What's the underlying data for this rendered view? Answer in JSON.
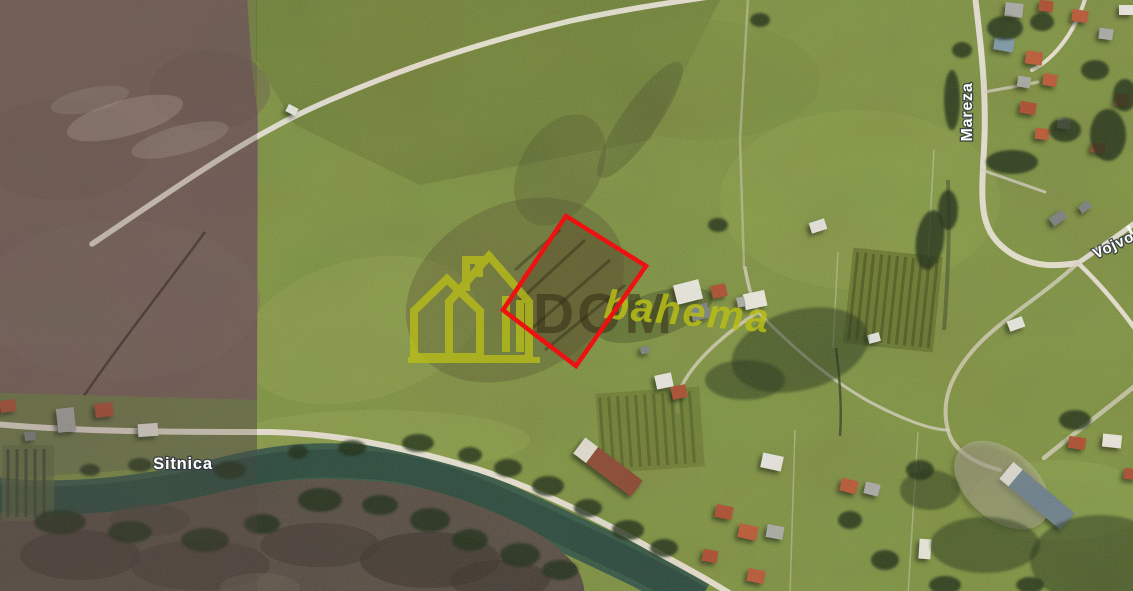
{
  "map": {
    "labels": {
      "river": "Sitnica",
      "road_mareza": "Mareza",
      "road_vojvode": "Vojvode"
    },
    "watermark": {
      "brand_prefix": "DOM",
      "brand_script": "bahema"
    },
    "colors": {
      "plot_outline_red": "#ee1111",
      "watermark_yellow": "#b9be18",
      "watermark_dark": "rgba(48,42,20,0.52)",
      "label_text": "#ffffff"
    }
  }
}
